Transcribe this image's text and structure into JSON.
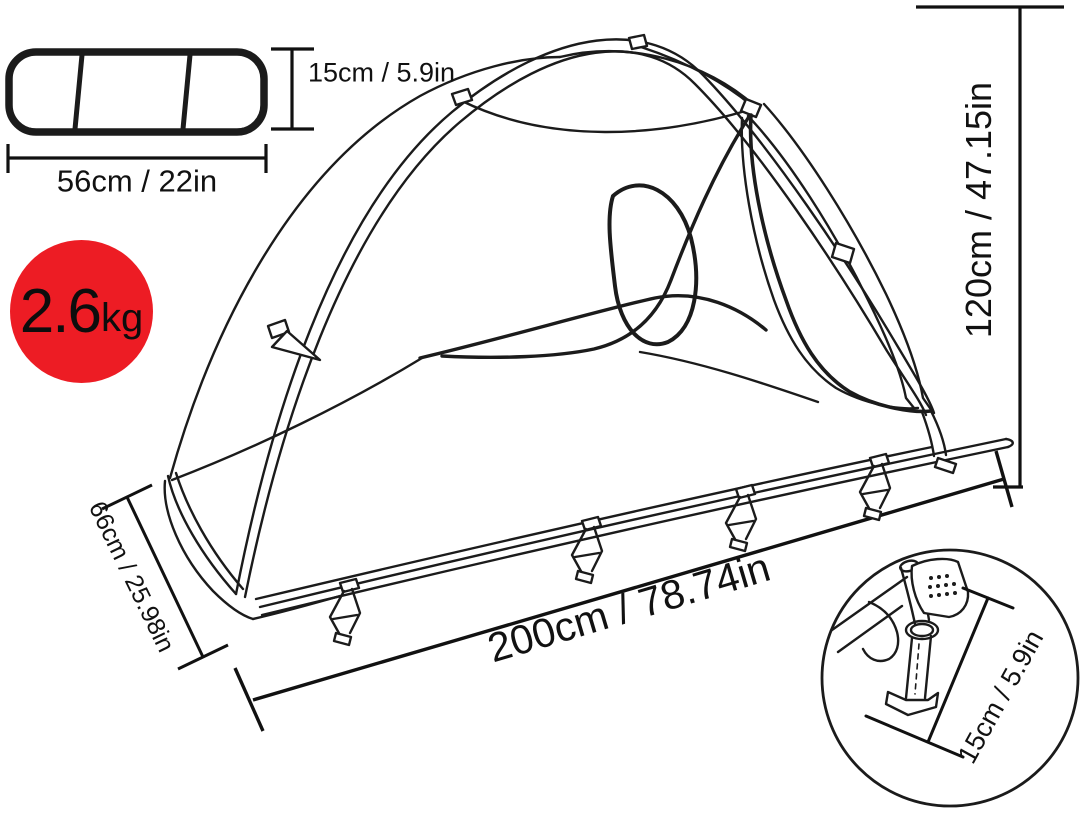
{
  "title": "Tent cot dimensions diagram",
  "colors": {
    "background": "#ffffff",
    "line": "#1b1b1b",
    "accent_red": "#ed1c24",
    "text": "#111111"
  },
  "weight_badge": {
    "value": "2.6",
    "unit": "kg"
  },
  "packed_bag": {
    "height_label": "15cm / 5.9in",
    "width_label": "56cm / 22in"
  },
  "tent": {
    "height_label": "120cm / 47.15in",
    "length_label": "200cm / 78.74in",
    "width_label": "66cm / 25.98in"
  },
  "leg_detail": {
    "height_label": "15cm / 5.9in"
  }
}
